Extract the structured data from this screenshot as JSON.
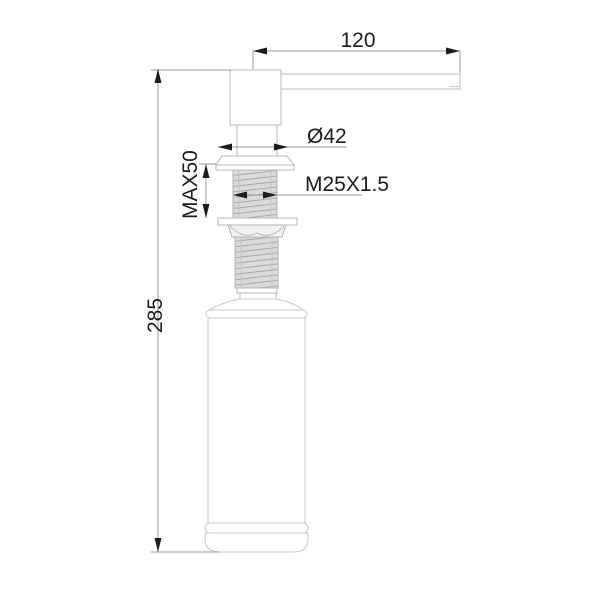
{
  "drawing": {
    "kind": "technical-dimension-drawing",
    "subject": "deck-mounted soap dispenser, side elevation",
    "dimensions": {
      "spout_reach": {
        "label": "120"
      },
      "flange_diameter": {
        "label": "Ø42"
      },
      "mounting_thickness_max": {
        "label": "MAX50"
      },
      "thread": {
        "label": "M25X1.5"
      },
      "total_height": {
        "label": "285"
      }
    },
    "colors": {
      "background": "#ffffff",
      "object_outline": "#b8b8b8",
      "dimension_line": "#9b9b9b",
      "text_and_arrows": "#1c1c1c",
      "thread_fill": "#dadada",
      "thread_hatch": "#a9a9a9"
    }
  }
}
